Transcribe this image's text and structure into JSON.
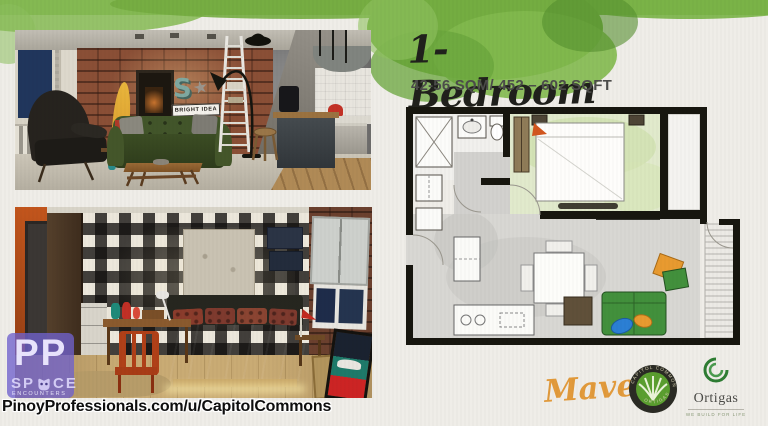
{
  "header": {
    "title": "1-Bedroom",
    "size_info": "42-56 SQM/ 452 – 602 SQFT"
  },
  "living_photo": {
    "sign_letter": "S",
    "sign_text": "BRIGHT IDEA"
  },
  "space_brand": {
    "initials": "PP",
    "left": "SP",
    "right": "CE",
    "sub": "ENCOUNTERS"
  },
  "footer": {
    "url": "PinoyProfessionals.com/u/CapitolCommons"
  },
  "branding": {
    "maven": "Maven",
    "badge_top": "CAPITOL COMMONS",
    "badge_bottom": "ORTIGAS",
    "ortigas": "Ortigas",
    "ortigas_tagline": "WE BUILD FOR LIFE"
  },
  "colors": {
    "watercolor_green": "#79b246",
    "maven_orange": "#e29a3b",
    "ortigas_green": "#2e7d33",
    "sofa_green": "#42903c",
    "accent_orange": "#e89a30",
    "accent_blue": "#2b7fd4"
  }
}
